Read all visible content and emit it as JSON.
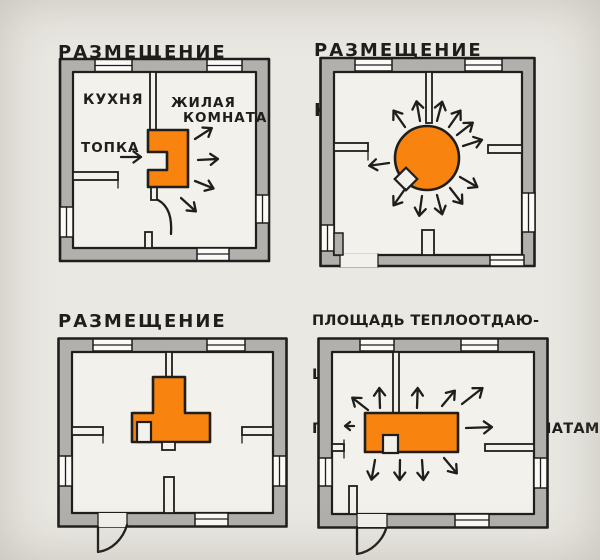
{
  "colors": {
    "paper": "#eae8e2",
    "room": "#f2f1ec",
    "wall": "#b2b0ad",
    "ink": "#1f1e1c",
    "stove_orange": "#f8830f"
  },
  "panels": {
    "cooking": {
      "title_lines": [
        "РАЗМЕЩЕНИЕ",
        "ВАРОЧНОЙ  ПЕЧИ"
      ],
      "labels": {
        "kitchen": "КУХНЯ",
        "living_line1": "ЖИЛАЯ",
        "living_line2": "КОМНАТА",
        "firebox": "ТОПКА"
      }
    },
    "round": {
      "title_lines": [
        "РАЗМЕЩЕНИЕ",
        "КРУГЛОЙ  ПЕЧИ"
      ]
    },
    "t_shaped": {
      "title_lines": [
        "РАЗМЕЩЕНИЕ",
        "Т-ОБРАЗНОЙ",
        "ПЕЧИ"
      ]
    },
    "proportional": {
      "title_lines": [
        "ПЛОЩАДЬ ТЕПЛООТДАЮ-",
        "ЩЕЙ ПОВЕРХНОСТИ ПЕЧИ",
        "ПРОПОРЦИОНАЛЬНА КОМНАТАМ"
      ]
    }
  }
}
